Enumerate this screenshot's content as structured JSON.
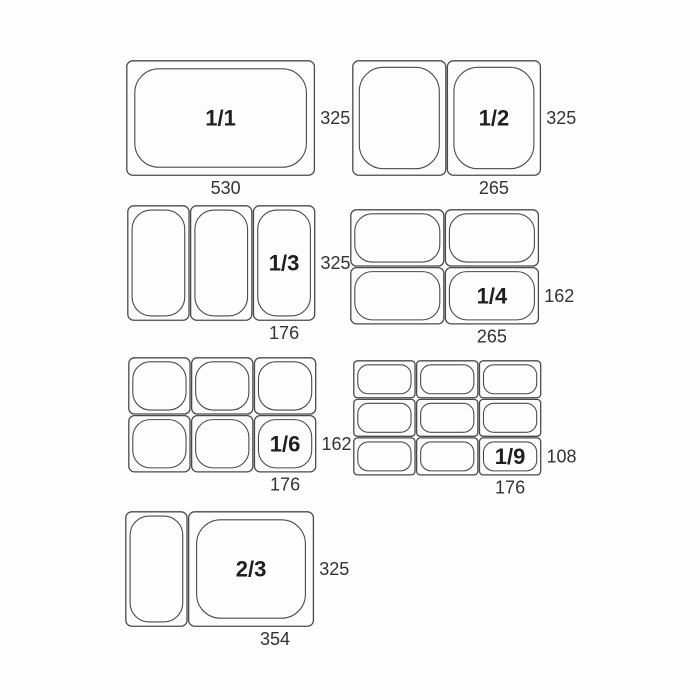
{
  "diagram": {
    "colors": {
      "background": "#fdfdfd",
      "line": "#4a4a4a",
      "fraction_text": "#1f1f1f",
      "dimension_text": "#333333"
    },
    "groups": [
      {
        "id": "1_1",
        "fraction_label": "1/1",
        "col_widths_mm": [
          530
        ],
        "row_heights_mm": [
          325
        ],
        "width_label": "530",
        "height_label": "325",
        "labeled_cell": {
          "col": 0,
          "row": 0
        }
      },
      {
        "id": "1_2",
        "fraction_label": "1/2",
        "col_widths_mm": [
          265,
          265
        ],
        "row_heights_mm": [
          325
        ],
        "width_label": "265",
        "height_label": "325",
        "labeled_cell": {
          "col": 1,
          "row": 0
        }
      },
      {
        "id": "1_3",
        "fraction_label": "1/3",
        "col_widths_mm": [
          176,
          176,
          176
        ],
        "row_heights_mm": [
          325
        ],
        "width_label": "176",
        "height_label": "325",
        "labeled_cell": {
          "col": 2,
          "row": 0
        }
      },
      {
        "id": "1_4",
        "fraction_label": "1/4",
        "col_widths_mm": [
          265,
          265
        ],
        "row_heights_mm": [
          162,
          162
        ],
        "width_label": "265",
        "height_label": "162",
        "labeled_cell": {
          "col": 1,
          "row": 1
        }
      },
      {
        "id": "1_6",
        "fraction_label": "1/6",
        "col_widths_mm": [
          176,
          176,
          176
        ],
        "row_heights_mm": [
          162,
          162
        ],
        "width_label": "176",
        "height_label": "162",
        "labeled_cell": {
          "col": 2,
          "row": 1
        }
      },
      {
        "id": "1_9",
        "fraction_label": "1/9",
        "col_widths_mm": [
          176,
          176,
          176
        ],
        "row_heights_mm": [
          108,
          108,
          108
        ],
        "width_label": "176",
        "height_label": "108",
        "labeled_cell": {
          "col": 2,
          "row": 2
        }
      },
      {
        "id": "2_3",
        "fraction_label": "2/3",
        "col_widths_mm": [
          176,
          354
        ],
        "row_heights_mm": [
          325
        ],
        "width_label": "354",
        "height_label": "325",
        "labeled_cell": {
          "col": 1,
          "row": 0
        }
      }
    ]
  }
}
